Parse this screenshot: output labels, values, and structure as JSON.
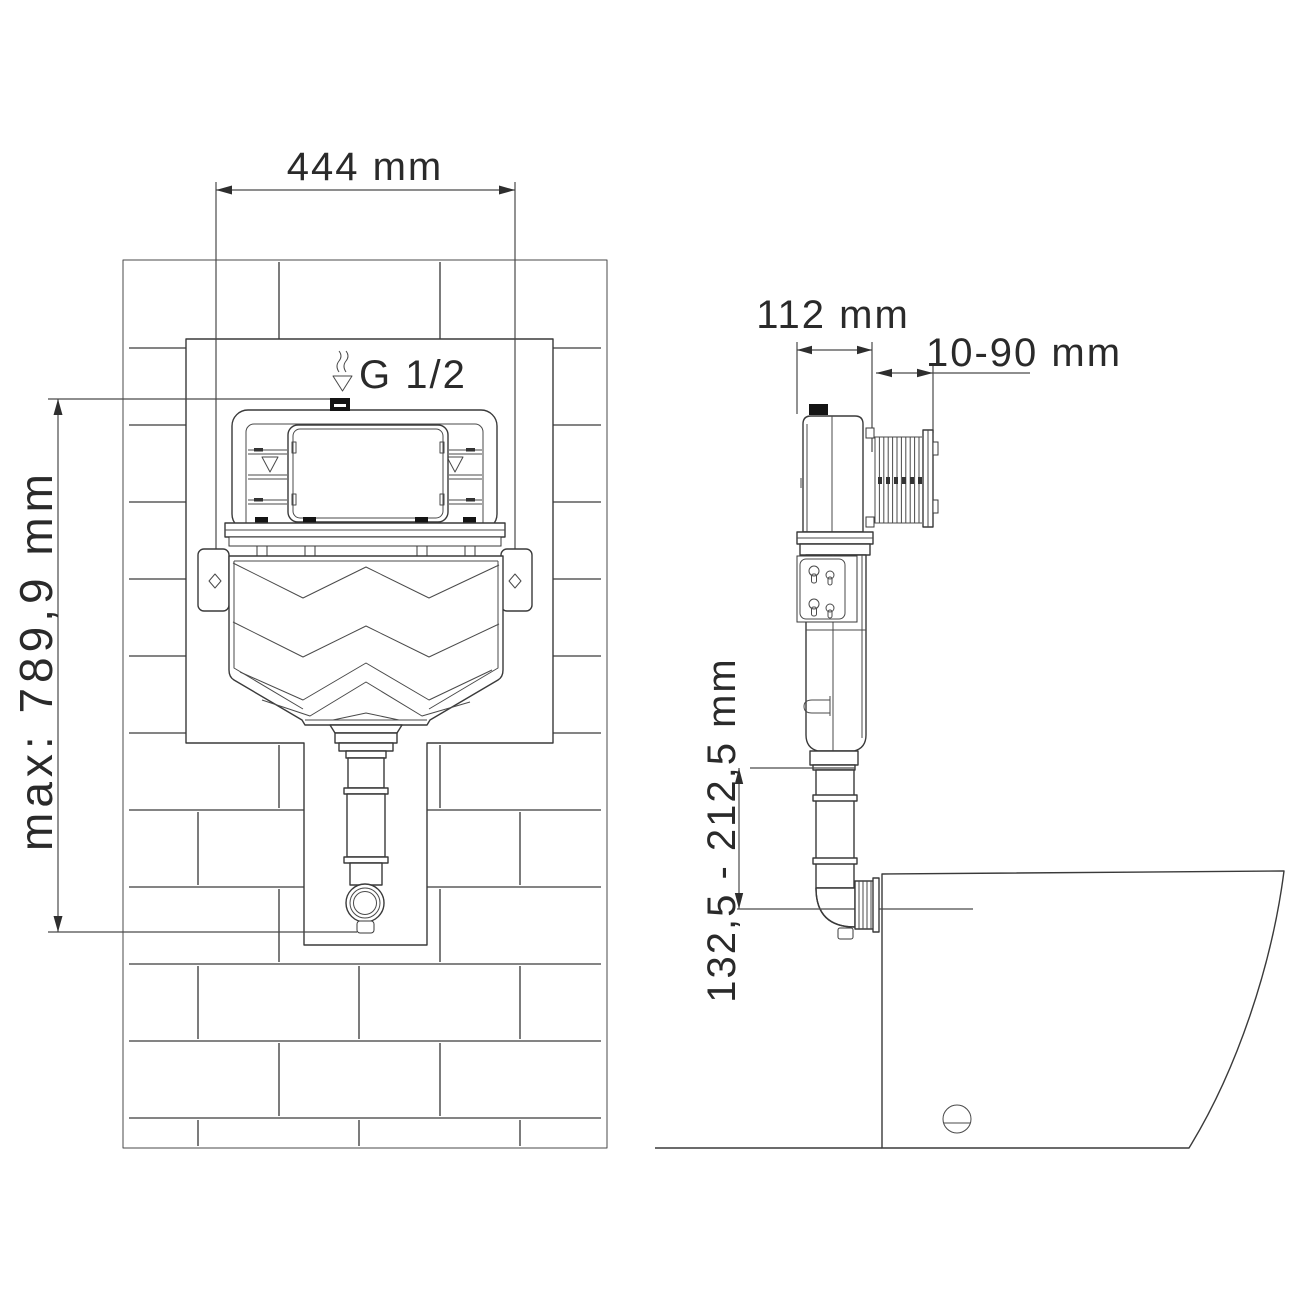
{
  "drawing": {
    "kind": "concealed-cistern-installation-diagram",
    "background": "#ffffff",
    "line_color": "#3a3a3a",
    "text_color": "#2a2a2a"
  },
  "front_view": {
    "label_width": "444 mm",
    "label_max_height": "max: 789,9 mm",
    "label_inlet_thread": "G 1/2"
  },
  "side_view": {
    "label_depth": "112 mm",
    "label_wall_finish_range": "10-90 mm",
    "label_flush_pipe_height": "132,5 - 212,5 mm"
  }
}
